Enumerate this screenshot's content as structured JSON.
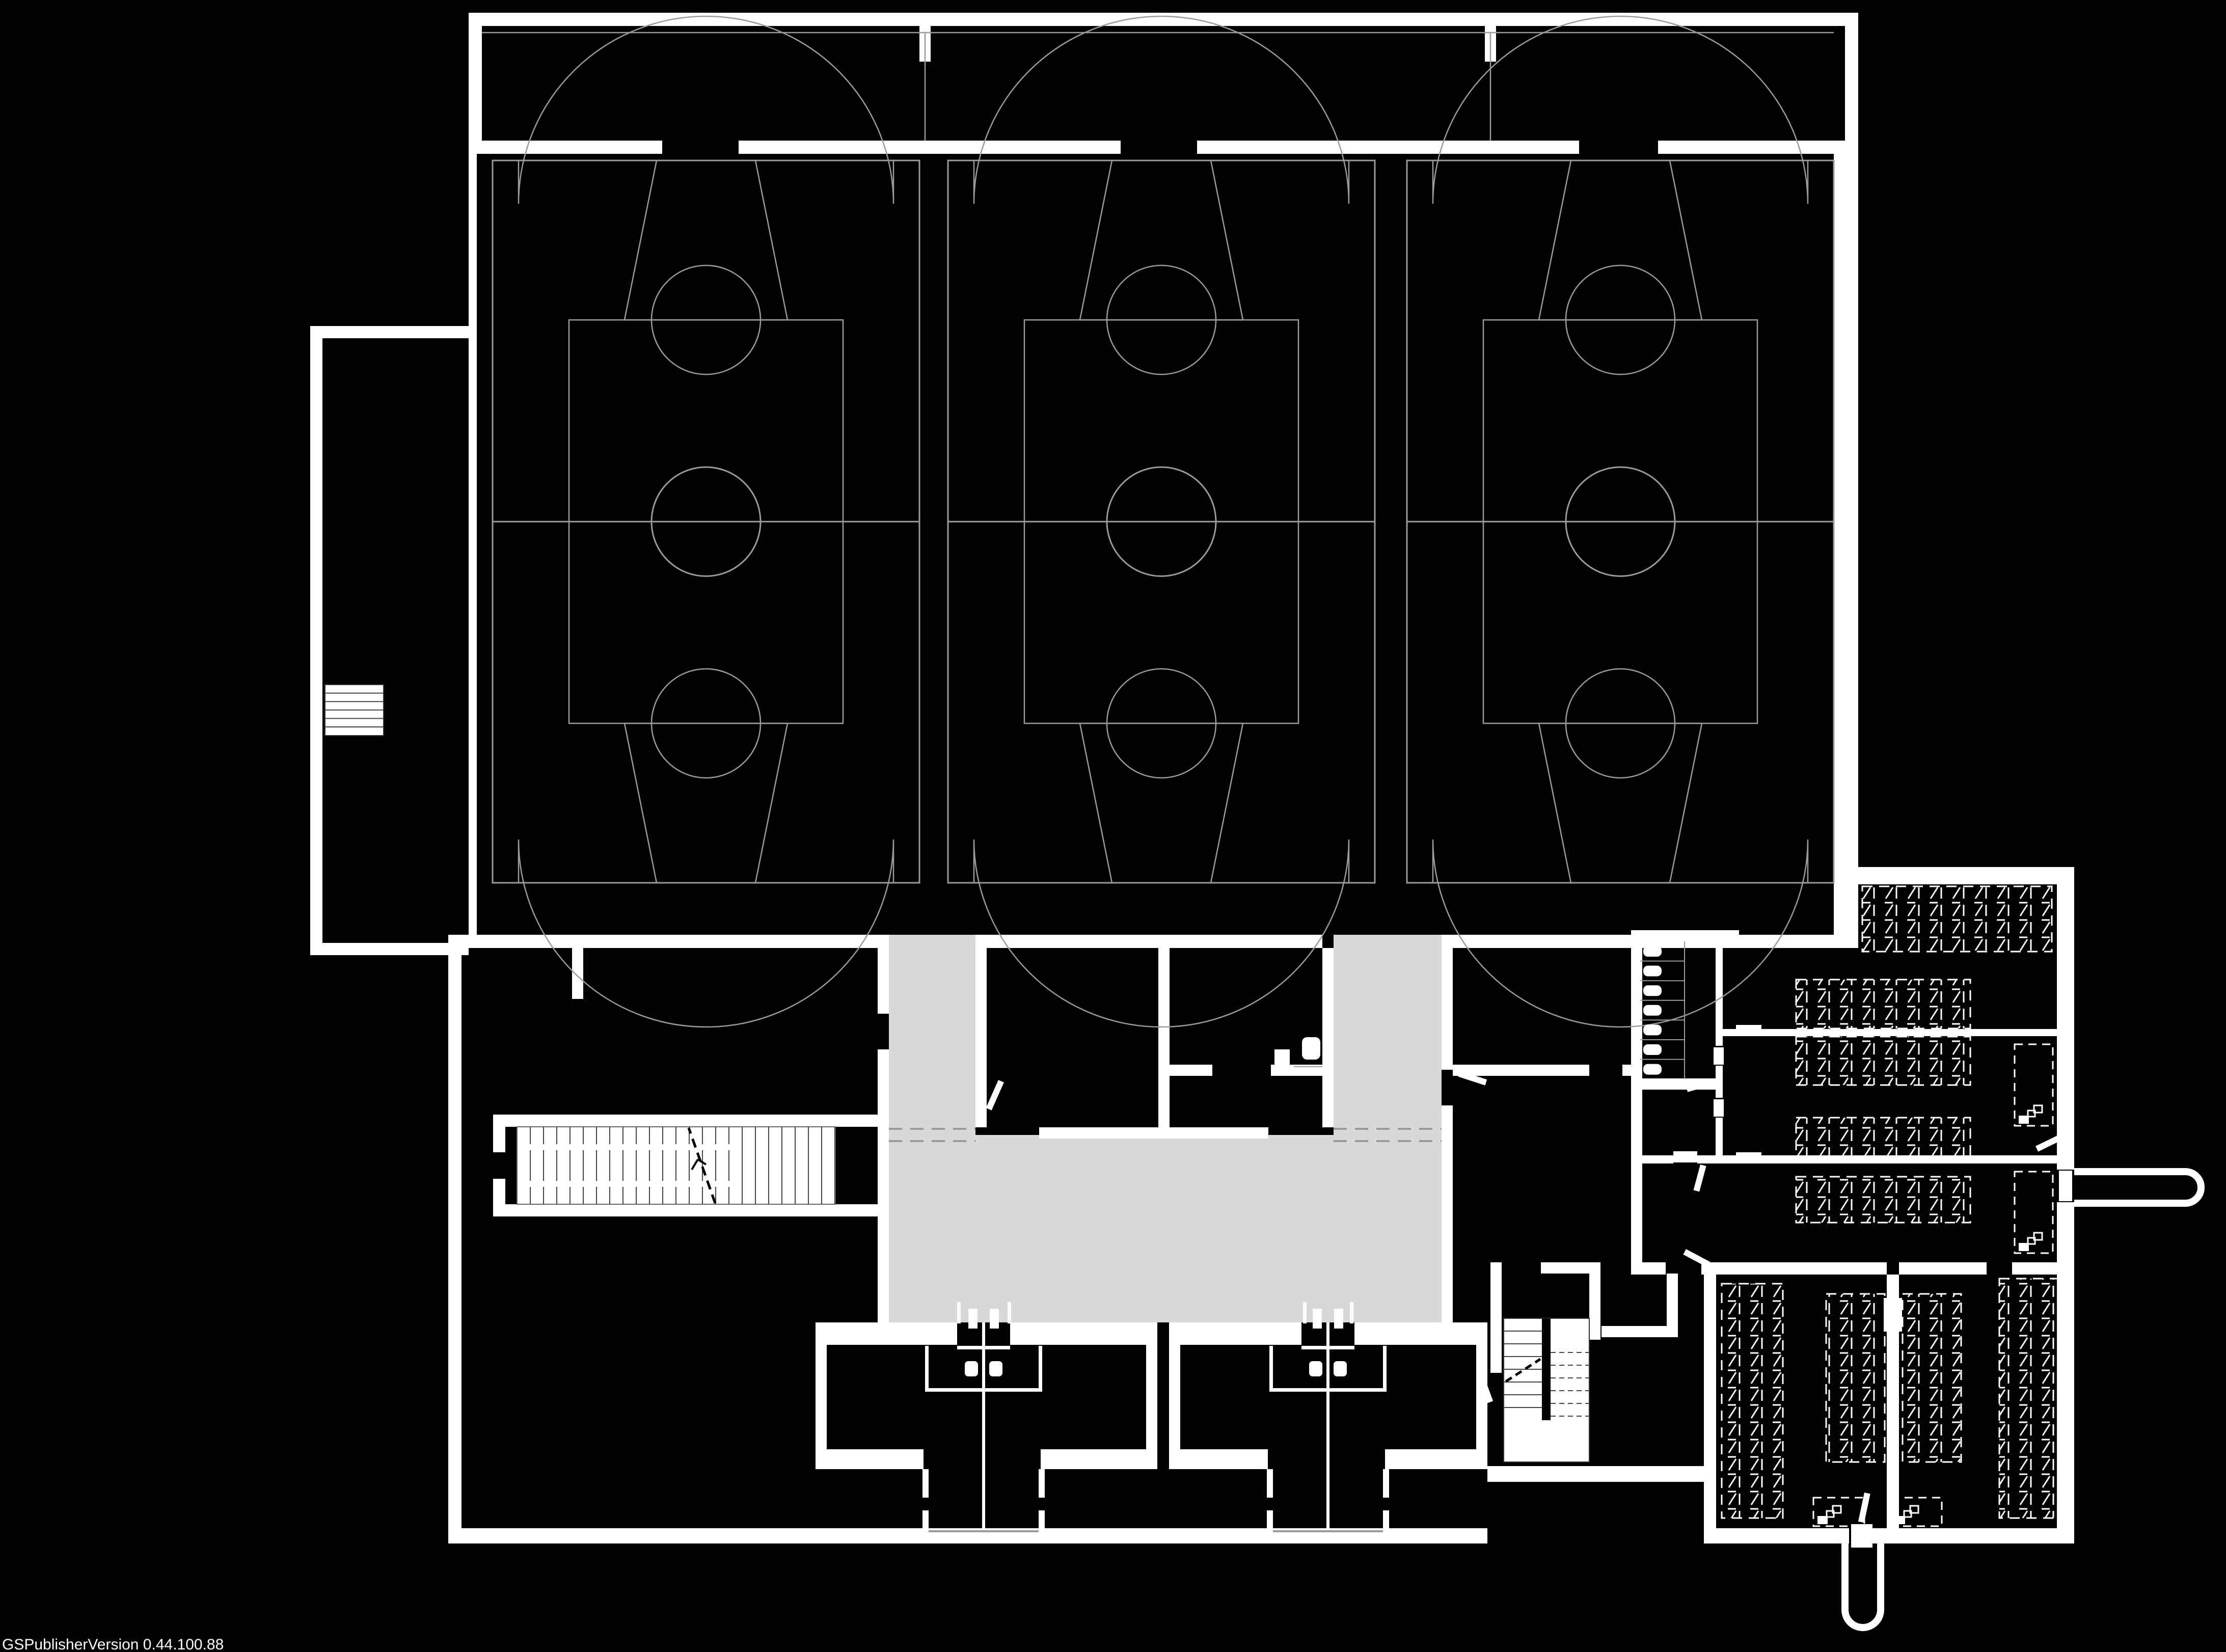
{
  "footer": {
    "version": "GSPublisherVersion 0.44.100.88"
  },
  "palette": {
    "background": "#000000",
    "walls": "#ffffff",
    "court_lines": "#9b9b9b",
    "corridor_fill": "#d8d8d8",
    "level_change_dash": "#999999",
    "hatch_marks": "#ffffff",
    "stair_treads": "#444444"
  },
  "plan": {
    "type": "architectural-floor-plan",
    "drawing_style": "white-linework-on-black",
    "basketball_courts": 3,
    "changing_room_pairs": 2,
    "changing_rooms": 4,
    "toilet_stalls": 7,
    "central_wc_rooms": 1,
    "stairs": [
      "west-straight-stair",
      "annex-stair",
      "dog-leg-stair"
    ],
    "hatched_storage_zones": 9,
    "dashed_equipment_boxes": 4,
    "exterior_ramps": 2,
    "level_change_marker_pairs": 2
  }
}
